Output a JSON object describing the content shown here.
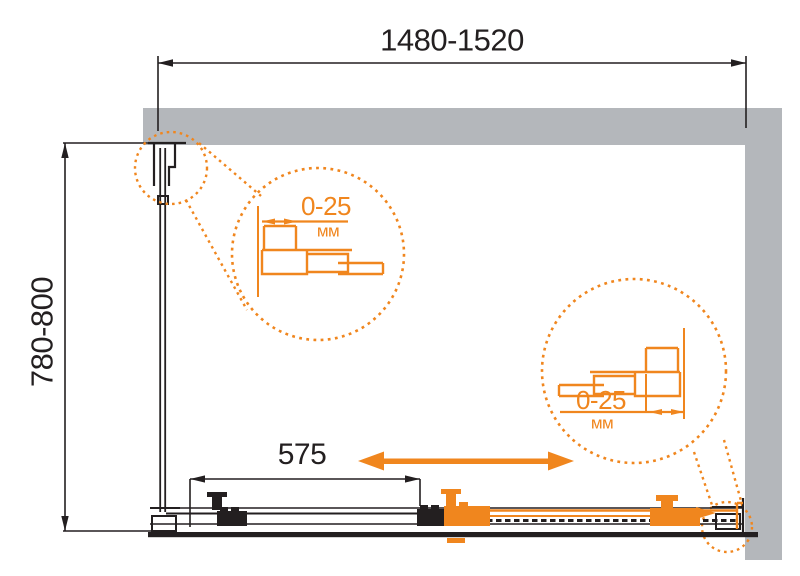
{
  "colors": {
    "accent": "#F0861E",
    "wall": "#B4B7BB",
    "line": "#231F20",
    "bg": "#FFFFFF"
  },
  "dimensions": {
    "overall_width": "1480-1520",
    "side_depth": "780-800",
    "door_panel": "575"
  },
  "detail_callouts": {
    "left": {
      "range": "0-25",
      "unit": "мм"
    },
    "right": {
      "range": "0-25",
      "unit": "мм"
    }
  }
}
